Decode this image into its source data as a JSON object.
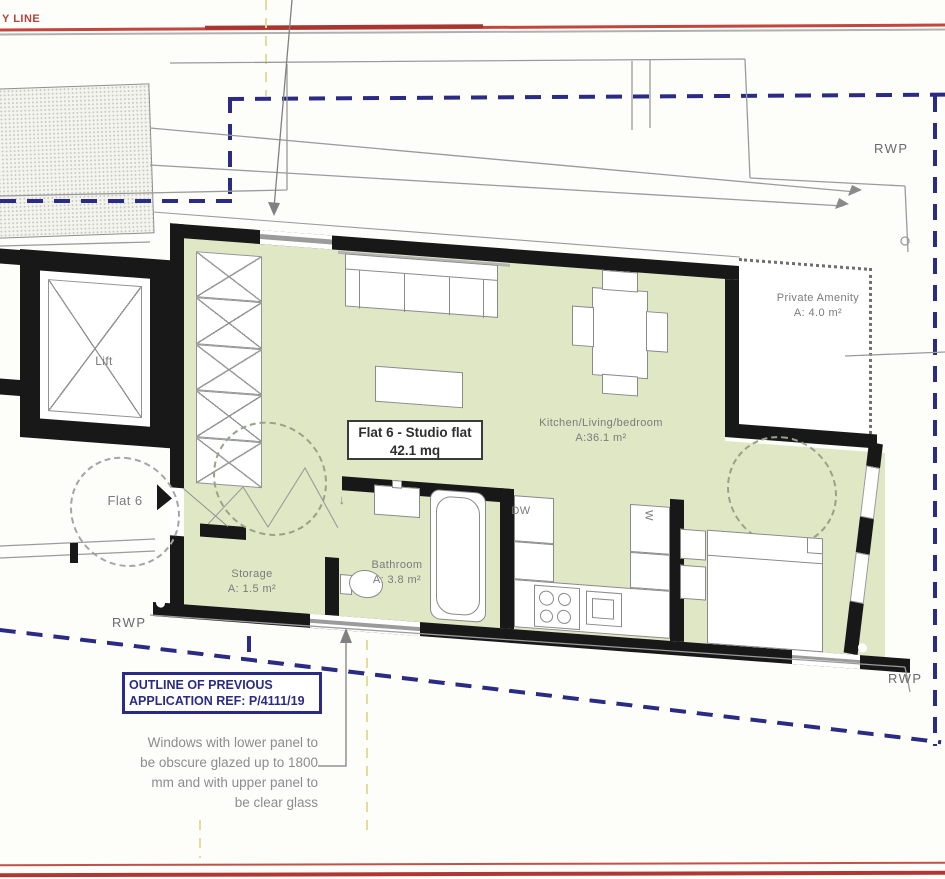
{
  "site": {
    "boundary_line_label": "Y LINE"
  },
  "unit": {
    "name": "Flat 6 - Studio flat",
    "area": "42.1 mq"
  },
  "rooms": {
    "lift": {
      "label": "Lift"
    },
    "hall": {
      "label": "Flat 6"
    },
    "storage": {
      "label": "Storage",
      "area": "A: 1.5 m²"
    },
    "bathroom": {
      "label": "Bathroom",
      "area": "A: 3.8 m²"
    },
    "kitchen_living_bedroom": {
      "label": "Kitchen/Living/bedroom",
      "area": "A:36.1 m²"
    },
    "private_amenity": {
      "label": "Private Amenity",
      "area": "A: 4.0 m²"
    }
  },
  "appliances": {
    "dishwasher": "DW",
    "washing_machine": "W"
  },
  "annotations": {
    "outline_box": [
      "OUTLINE OF PREVIOUS",
      "APPLICATION REF: P/4111/19"
    ],
    "glazing_note": [
      "Windows with lower panel to",
      "be obscure glazed up to 1800",
      "mm and with upper panel to",
      "be clear glass"
    ],
    "rwp_top_right": "RWP",
    "rwp_bottom_right": "RWP",
    "rwp_left": "RWP",
    "bathroom_arrow": "↓"
  },
  "colors": {
    "boundary_red": "#b6403a",
    "outline_navy": "#2b2b85",
    "floor_green": "#dfe7c5",
    "wall_black": "#181818",
    "site_gray": "#9b9b9b",
    "text_gray": "#7b7b7b",
    "yellow_dash": "#e4dc9c"
  }
}
